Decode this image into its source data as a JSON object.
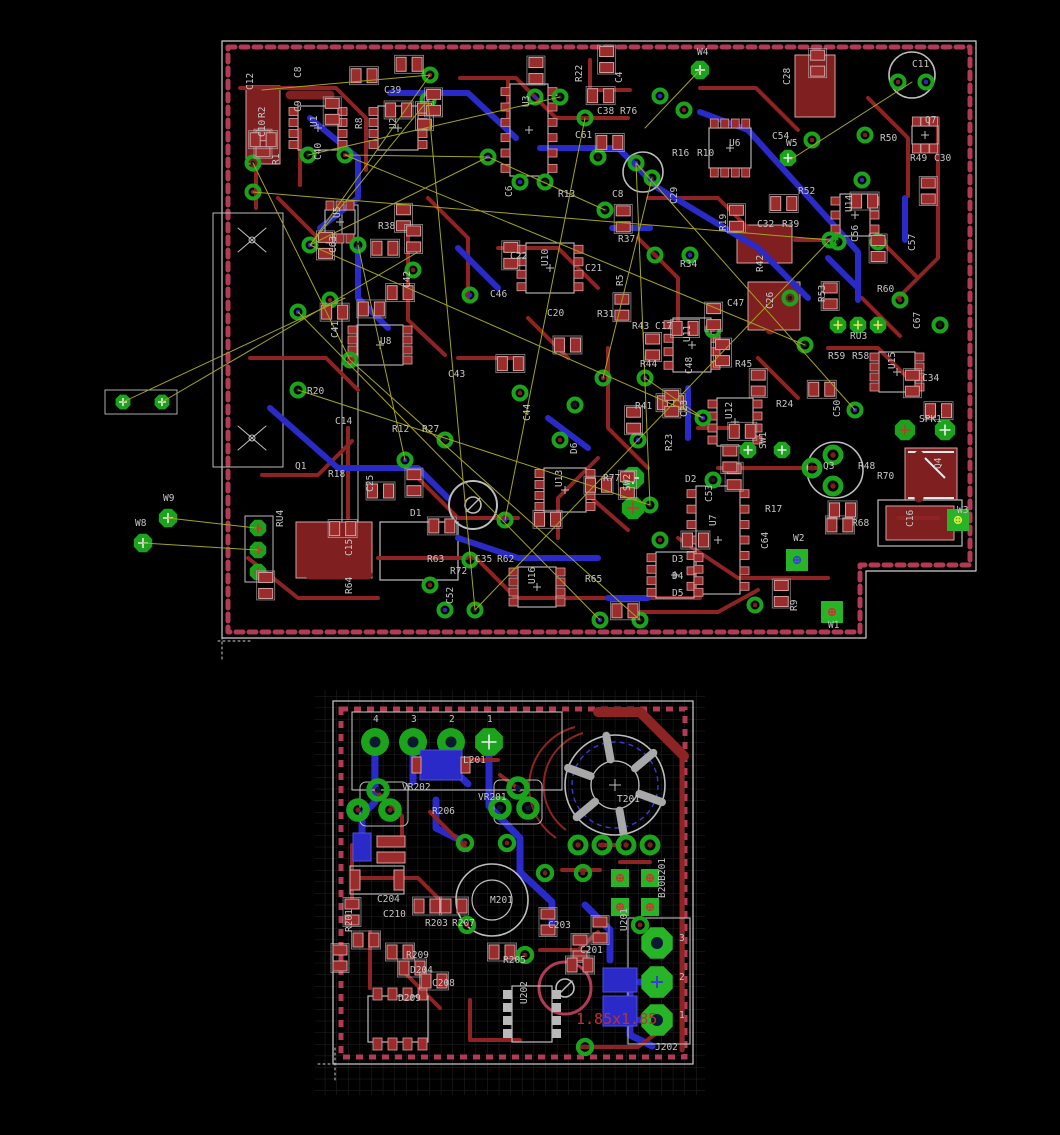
{
  "app": {
    "view_title": "pcb-layout-view"
  },
  "colors": {
    "background": "#000000",
    "copper_top": "#8e2323",
    "copper_pour": "#7f1f1f",
    "pad_red": "#9b2c2c",
    "pad_red_stroke": "#d8a0a0",
    "copper_bottom": "#2a2ac8",
    "pad_green": "#1ba31b",
    "pad_green_bright": "#27b427",
    "silkscreen": "#bdbdbd",
    "label_text": "#c6c6c6",
    "board_outline_dash": "#b23a54",
    "airwire": "#a3a320",
    "grid": "#232323",
    "dimension_text": "#c23030"
  },
  "boards": {
    "main": {
      "name": "main-board",
      "labels": [
        [
          "C12",
          253,
          90,
          1
        ],
        [
          "C8",
          301,
          78,
          1
        ],
        [
          "C9",
          301,
          112,
          1
        ],
        [
          "R2",
          265,
          118,
          1
        ],
        [
          "C10",
          265,
          137,
          1
        ],
        [
          "U1",
          317,
          127,
          1
        ],
        [
          "R1",
          279,
          165,
          1
        ],
        [
          "C40",
          321,
          160,
          1
        ],
        [
          "C39",
          384,
          93,
          0
        ],
        [
          "R8",
          362,
          129,
          1
        ],
        [
          "U2",
          396,
          129,
          1
        ],
        [
          "U3",
          529,
          107,
          1
        ],
        [
          "C61",
          575,
          138,
          0
        ],
        [
          "C38",
          597,
          114,
          0
        ],
        [
          "R76",
          620,
          114,
          0
        ],
        [
          "C4",
          622,
          83,
          1
        ],
        [
          "R22",
          582,
          82,
          1
        ],
        [
          "W4",
          697,
          55,
          0
        ],
        [
          "C28",
          790,
          85,
          1
        ],
        [
          "U6",
          729,
          146,
          0
        ],
        [
          "C54",
          772,
          139,
          0
        ],
        [
          "W5",
          786,
          146,
          0
        ],
        [
          "R16",
          672,
          156,
          0
        ],
        [
          "R10",
          697,
          156,
          0
        ],
        [
          "C6",
          512,
          197,
          1
        ],
        [
          "R13",
          558,
          197,
          0
        ],
        [
          "C8",
          612,
          197,
          0
        ],
        [
          "C29",
          677,
          204,
          1
        ],
        [
          "C11",
          912,
          67,
          0
        ],
        [
          "Q7",
          925,
          123,
          0
        ],
        [
          "R50",
          880,
          141,
          0
        ],
        [
          "R49",
          910,
          161,
          0
        ],
        [
          "C30",
          934,
          161,
          0
        ],
        [
          "R52",
          798,
          194,
          0
        ],
        [
          "U5",
          340,
          218,
          1
        ],
        [
          "R38",
          378,
          229,
          0
        ],
        [
          "C63",
          336,
          253,
          1
        ],
        [
          "C42",
          410,
          288,
          1
        ],
        [
          "C46",
          490,
          297,
          0
        ],
        [
          "U8",
          380,
          344,
          0
        ],
        [
          "C41",
          338,
          338,
          1
        ],
        [
          "C43",
          448,
          377,
          0
        ],
        [
          "C22",
          510,
          259,
          0
        ],
        [
          "U10",
          548,
          266,
          1
        ],
        [
          "C21",
          585,
          271,
          0
        ],
        [
          "R37",
          618,
          242,
          0
        ],
        [
          "R5",
          623,
          286,
          1
        ],
        [
          "R34",
          680,
          267,
          0
        ],
        [
          "R31",
          597,
          317,
          0
        ],
        [
          "C20",
          547,
          316,
          0
        ],
        [
          "R43",
          632,
          329,
          0
        ],
        [
          "C17",
          655,
          329,
          0
        ],
        [
          "U11",
          690,
          342,
          1
        ],
        [
          "R44",
          640,
          367,
          0
        ],
        [
          "R45",
          735,
          367,
          0
        ],
        [
          "C48",
          692,
          374,
          1
        ],
        [
          "C47",
          727,
          306,
          0
        ],
        [
          "C26",
          773,
          309,
          1
        ],
        [
          "R42",
          763,
          272,
          1
        ],
        [
          "R39",
          782,
          227,
          0
        ],
        [
          "C32",
          757,
          227,
          0
        ],
        [
          "R19",
          726,
          231,
          1
        ],
        [
          "U14",
          852,
          212,
          1
        ],
        [
          "C56",
          858,
          242,
          1
        ],
        [
          "R53",
          825,
          302,
          1
        ],
        [
          "R60",
          877,
          292,
          0
        ],
        [
          "C57",
          915,
          251,
          1
        ],
        [
          "C67",
          920,
          329,
          1
        ],
        [
          "RU3",
          850,
          339,
          0
        ],
        [
          "R59",
          828,
          359,
          0
        ],
        [
          "R58",
          852,
          359,
          0
        ],
        [
          "U15",
          895,
          369,
          1
        ],
        [
          "C34",
          922,
          381,
          0
        ],
        [
          "R20",
          307,
          394,
          0
        ],
        [
          "C14",
          335,
          424,
          0
        ],
        [
          "R12",
          392,
          432,
          0
        ],
        [
          "R27",
          422,
          432,
          0
        ],
        [
          "Q1",
          295,
          469,
          0
        ],
        [
          "R18",
          328,
          477,
          0
        ],
        [
          "C25",
          373,
          492,
          1
        ],
        [
          "D1",
          410,
          516,
          0
        ],
        [
          "RU4",
          283,
          527,
          1
        ],
        [
          "C15",
          352,
          556,
          1
        ],
        [
          "R64",
          352,
          594,
          1
        ],
        [
          "R63",
          427,
          562,
          0
        ],
        [
          "R72",
          450,
          574,
          0
        ],
        [
          "C35",
          475,
          562,
          0
        ],
        [
          "R62",
          497,
          562,
          0
        ],
        [
          "C52",
          453,
          604,
          1
        ],
        [
          "U16",
          535,
          584,
          1
        ],
        [
          "R65",
          585,
          582,
          0
        ],
        [
          "R41",
          635,
          409,
          0
        ],
        [
          "C23",
          687,
          417,
          1
        ],
        [
          "U12",
          732,
          419,
          1
        ],
        [
          "R24",
          776,
          407,
          0
        ],
        [
          "R23",
          672,
          451,
          1
        ],
        [
          "SW1",
          766,
          449,
          1
        ],
        [
          "D6",
          577,
          454,
          1
        ],
        [
          "R77",
          603,
          481,
          0
        ],
        [
          "SW2",
          630,
          491,
          1
        ],
        [
          "D2",
          685,
          482,
          0
        ],
        [
          "U13",
          562,
          487,
          1
        ],
        [
          "C44",
          530,
          421,
          1
        ],
        [
          "SPK1",
          919,
          422,
          0
        ],
        [
          "Q4",
          941,
          469,
          1
        ],
        [
          "R48",
          858,
          469,
          0
        ],
        [
          "R70",
          877,
          479,
          0
        ],
        [
          "Q3",
          823,
          469,
          0
        ],
        [
          "C50",
          840,
          417,
          1
        ],
        [
          "R68",
          852,
          526,
          0
        ],
        [
          "C16",
          913,
          527,
          1
        ],
        [
          "W3",
          957,
          513,
          0
        ],
        [
          "W2",
          793,
          541,
          0
        ],
        [
          "U7",
          716,
          526,
          1
        ],
        [
          "C53",
          712,
          502,
          1
        ],
        [
          "R17",
          765,
          512,
          0
        ],
        [
          "C64",
          768,
          549,
          1
        ],
        [
          "D3",
          672,
          562,
          0
        ],
        [
          "D4",
          672,
          579,
          0
        ],
        [
          "D5",
          672,
          596,
          0
        ],
        [
          "R9",
          797,
          611,
          1
        ],
        [
          "W1",
          828,
          628,
          0
        ],
        [
          "W8",
          135,
          526,
          0
        ],
        [
          "W9",
          163,
          501,
          0
        ]
      ]
    },
    "power": {
      "name": "power-board",
      "dimension_note": "1.85x1.85",
      "labels": [
        [
          "4",
          373,
          722,
          0
        ],
        [
          "3",
          411,
          722,
          0
        ],
        [
          "2",
          449,
          722,
          0
        ],
        [
          "1",
          487,
          722,
          0
        ],
        [
          "L201",
          463,
          763,
          0
        ],
        [
          "VR202",
          402,
          790,
          0
        ],
        [
          "VR201",
          478,
          800,
          0
        ],
        [
          "R206",
          432,
          814,
          0
        ],
        [
          "T201",
          617,
          802,
          0
        ],
        [
          "C204",
          377,
          902,
          0
        ],
        [
          "C210",
          383,
          917,
          0
        ],
        [
          "M201",
          490,
          903,
          0
        ],
        [
          "R201",
          352,
          932,
          1
        ],
        [
          "R203",
          425,
          926,
          0
        ],
        [
          "R207",
          452,
          926,
          0
        ],
        [
          "C203",
          548,
          928,
          0
        ],
        [
          "R209",
          406,
          958,
          0
        ],
        [
          "D204",
          410,
          973,
          0
        ],
        [
          "C208",
          432,
          986,
          0
        ],
        [
          "D209",
          398,
          1001,
          0
        ],
        [
          "R205",
          503,
          963,
          0
        ],
        [
          "U202",
          527,
          1004,
          1
        ],
        [
          "C201",
          580,
          953,
          0
        ],
        [
          "U201",
          627,
          931,
          1
        ],
        [
          "B20B201",
          665,
          898,
          1
        ],
        [
          "J202",
          655,
          1050,
          0
        ],
        [
          "3",
          679,
          941,
          0
        ],
        [
          "2",
          679,
          980,
          0
        ],
        [
          "1",
          679,
          1018,
          0
        ],
        [
          "1.85x1.85",
          576,
          1024,
          0,
          "dim"
        ]
      ]
    }
  }
}
